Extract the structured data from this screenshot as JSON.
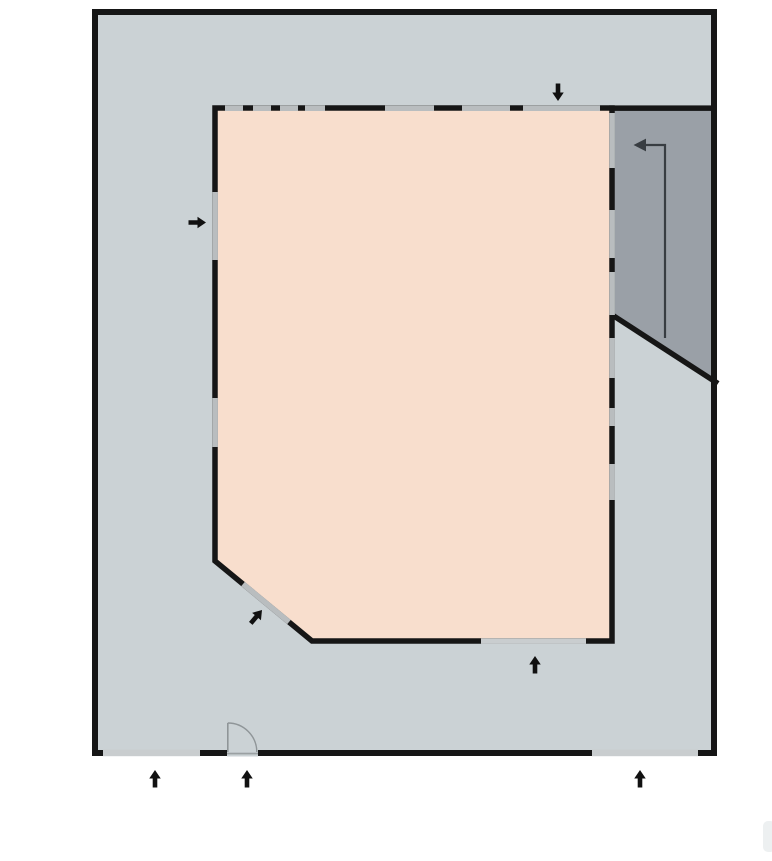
{
  "colors": {
    "background": "#ffffff",
    "site_fill": "#cbd2d5",
    "room_fill": "#f8decd",
    "ramp_fill": "#9aa0a7",
    "wall": "#161616",
    "window_fill": "#b9bdbf",
    "site_window_fill": "#c9cdcf",
    "threshold": "#9aa0a2",
    "door": "#8f9598",
    "route_arrow": "#383d42",
    "arrow": "#111111",
    "edge_artifact": "#edf0f1"
  },
  "geometry": {
    "room_top_y": 105.4,
    "room_bottom_y": 638.3,
    "room_left_x": 212.3,
    "room_right_x": 609.3,
    "wall_thickness": 5.6,
    "site_bottom_y": 749.6,
    "site_wall_thickness": 6.6
  },
  "windows": {
    "room": [
      {
        "wall": "top",
        "x1": 225,
        "x2": 243
      },
      {
        "wall": "top",
        "x1": 253,
        "x2": 271
      },
      {
        "wall": "top",
        "x1": 280,
        "x2": 298
      },
      {
        "wall": "top",
        "x1": 305,
        "x2": 325
      },
      {
        "wall": "top",
        "x1": 385,
        "x2": 434
      },
      {
        "wall": "top",
        "x1": 462,
        "x2": 510
      },
      {
        "wall": "top",
        "x1": 523,
        "x2": 600
      },
      {
        "wall": "left",
        "y1": 192,
        "y2": 260
      },
      {
        "wall": "left",
        "y1": 398,
        "y2": 447
      },
      {
        "wall": "right",
        "y1": 113,
        "y2": 168
      },
      {
        "wall": "right",
        "y1": 210,
        "y2": 258
      },
      {
        "wall": "right",
        "y1": 272,
        "y2": 315
      },
      {
        "wall": "right",
        "y1": 338,
        "y2": 378
      },
      {
        "wall": "right",
        "y1": 408,
        "y2": 426
      },
      {
        "wall": "right",
        "y1": 464,
        "y2": 500
      },
      {
        "wall": "bottom",
        "x1": 481,
        "x2": 586,
        "tone": "light"
      },
      {
        "wall": "chamfer",
        "x1": 243,
        "y1": 584,
        "x2": 289,
        "y2": 622
      }
    ],
    "site": [
      {
        "wall": "bottom",
        "x1": 103,
        "x2": 200
      },
      {
        "wall": "bottom",
        "x1": 592,
        "x2": 698
      }
    ]
  },
  "arrows": {
    "shape": {
      "stem_length": 9,
      "stem_width": 4.6,
      "head_length": 8.5,
      "head_width": 11.5
    },
    "entrances": [
      {
        "id": "entrance-arrow-top",
        "direction": "down",
        "x": 558,
        "y": 101,
        "angle": 90
      },
      {
        "id": "entrance-arrow-left",
        "direction": "right",
        "x": 206,
        "y": 222.5,
        "angle": 0
      },
      {
        "id": "entrance-arrow-chamfer",
        "direction": "up-right",
        "x": 262,
        "y": 610,
        "angle": -50
      },
      {
        "id": "entrance-arrow-room-bottom",
        "direction": "up",
        "x": 535,
        "y": 656,
        "angle": -90
      },
      {
        "id": "entrance-arrow-bottom-1",
        "direction": "up",
        "x": 155,
        "y": 770,
        "angle": -90
      },
      {
        "id": "entrance-arrow-bottom-2",
        "direction": "up",
        "x": 247,
        "y": 770,
        "angle": -90
      },
      {
        "id": "entrance-arrow-bottom-3",
        "direction": "up",
        "x": 640,
        "y": 770,
        "angle": -90
      }
    ],
    "ramp_route": {
      "id": "ramp-direction-arrow",
      "direction": "left",
      "path": [
        [
          665,
          338
        ],
        [
          665,
          145
        ],
        [
          641,
          145
        ]
      ],
      "head": [
        [
          633.5,
          145
        ],
        [
          646,
          138.6
        ],
        [
          646,
          151.4
        ]
      ]
    }
  }
}
